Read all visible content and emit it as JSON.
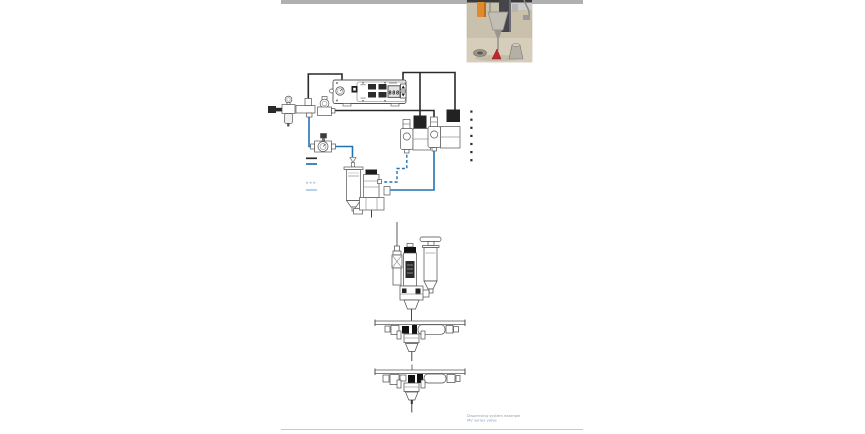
{
  "page": {
    "bg": "#ffffff",
    "top_bar_color": "#b0b0b0",
    "bottom_rule_color": "#c9c9c9"
  },
  "colors": {
    "line_dark": "#2a2a2a",
    "line_blue": "#2273b5",
    "line_light_blue": "#aacbe4",
    "outline": "#4a4a4a",
    "component_dark": "#1e1e1e"
  },
  "controller": {
    "display_value": "888"
  },
  "legend": {
    "items": [
      {
        "name": "dark-solid-line",
        "color": "#2a2a2a",
        "dash": ""
      },
      {
        "name": "blue-solid-line",
        "color": "#2273b5",
        "dash": ""
      },
      {
        "name": "light-blue-dashed-line",
        "color": "#aacbe4",
        "dash": "2,1.6"
      },
      {
        "name": "light-blue-solid-line",
        "color": "#aacbe4",
        "dash": ""
      }
    ]
  },
  "bullet_list": {
    "count": 7
  },
  "caption": {
    "line1": "Dispensing system example",
    "line1_color": "#9b9b9b",
    "line2": "MV series valve",
    "line2_color": "#7d9ec7"
  },
  "photo": {
    "bg": "#c9c1ac"
  }
}
